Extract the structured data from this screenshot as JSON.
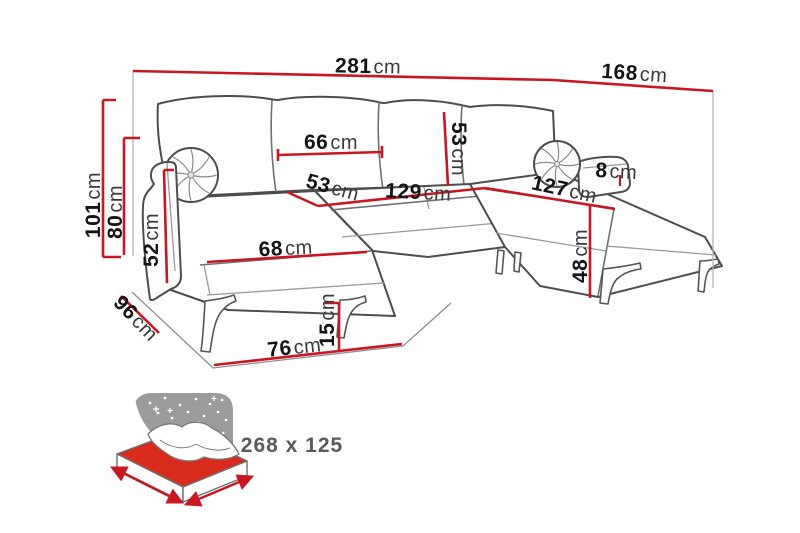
{
  "diagram": {
    "kind": "corner-sofa-dimension-diagram",
    "unit": "cm"
  },
  "dimensions": {
    "overall_width": {
      "value": "281",
      "unit": "cm"
    },
    "right_section_depth": {
      "value": "168",
      "unit": "cm"
    },
    "overall_height": {
      "value": "101",
      "unit": "cm"
    },
    "armrest_height": {
      "value": "80",
      "unit": "cm"
    },
    "armrest_panel_height": {
      "value": "52",
      "unit": "cm"
    },
    "left_section_depth": {
      "value": "96",
      "unit": "cm"
    },
    "back_cushion_width": {
      "value": "66",
      "unit": "cm"
    },
    "back_cushion_height": {
      "value": "53",
      "unit": "cm"
    },
    "seat_depth": {
      "value": "53",
      "unit": "cm"
    },
    "seat_width": {
      "value": "129",
      "unit": "cm"
    },
    "right_chaise_length": {
      "value": "127",
      "unit": "cm"
    },
    "armrest_width": {
      "value": "8",
      "unit": "cm"
    },
    "left_chaise_seat_width": {
      "value": "68",
      "unit": "cm"
    },
    "left_chaise_length": {
      "value": "76",
      "unit": "cm"
    },
    "leg_height": {
      "value": "15",
      "unit": "cm"
    },
    "seat_height": {
      "value": "48",
      "unit": "cm"
    }
  },
  "sleeping_function": {
    "icon": "sleeping-function-bed-icon",
    "dimensions_label": "268 x 125"
  },
  "colors": {
    "dimension_line": "#c81723",
    "sofa_outline": "#4d4d4d",
    "label_number": "#141414",
    "label_unit": "#3a3a3a",
    "icon_night_gray": "#9b9b9b",
    "mattress_red": "#d92b1c",
    "sleeping_label_gray": "#5a5a5a"
  }
}
